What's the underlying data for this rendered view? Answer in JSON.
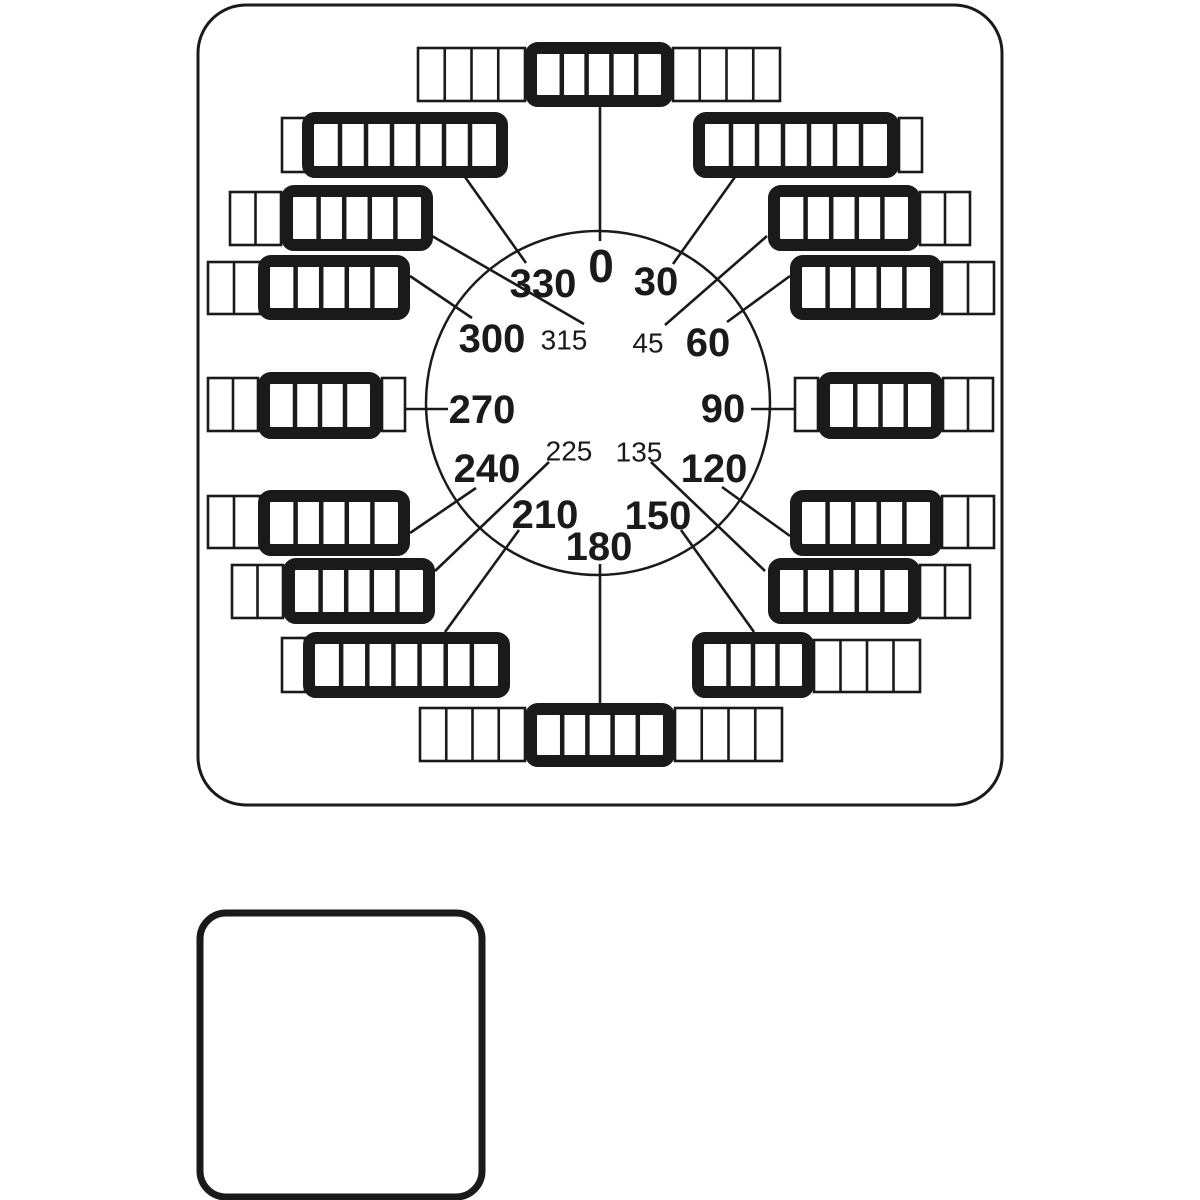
{
  "diagram": {
    "description": "Rotary dial diagram with degree circle and segmented switch blocks at each angle, plus a blank rounded panel below",
    "ink_color": "#1a1a1a",
    "background_color": "#ffffff",
    "panel": {
      "x": 198,
      "y": 5,
      "w": 804,
      "h": 800,
      "rx": 48,
      "stroke_w": 3
    },
    "circle": {
      "cx": 598,
      "cy": 403,
      "r": 172,
      "stroke_w": 2.5
    },
    "blank_panel": {
      "x": 200,
      "y": 913,
      "w": 282,
      "h": 284,
      "rx": 26,
      "stroke_w": 7
    },
    "labels_major": [
      {
        "text": "0",
        "x": 601,
        "y": 266,
        "size": 46
      },
      {
        "text": "30",
        "x": 656,
        "y": 282,
        "size": 40
      },
      {
        "text": "60",
        "x": 708,
        "y": 343,
        "size": 40
      },
      {
        "text": "90",
        "x": 723,
        "y": 409,
        "size": 40
      },
      {
        "text": "120",
        "x": 714,
        "y": 469,
        "size": 40
      },
      {
        "text": "150",
        "x": 658,
        "y": 516,
        "size": 40
      },
      {
        "text": "180",
        "x": 599,
        "y": 547,
        "size": 40
      },
      {
        "text": "210",
        "x": 545,
        "y": 515,
        "size": 40
      },
      {
        "text": "240",
        "x": 487,
        "y": 469,
        "size": 40
      },
      {
        "text": "270",
        "x": 482,
        "y": 410,
        "size": 40
      },
      {
        "text": "300",
        "x": 492,
        "y": 339,
        "size": 40
      },
      {
        "text": "330",
        "x": 543,
        "y": 284,
        "size": 40
      }
    ],
    "labels_minor": [
      {
        "text": "45",
        "x": 648,
        "y": 343,
        "size": 28
      },
      {
        "text": "135",
        "x": 639,
        "y": 452,
        "size": 28
      },
      {
        "text": "225",
        "x": 569,
        "y": 451,
        "size": 28
      },
      {
        "text": "315",
        "x": 564,
        "y": 340,
        "size": 28
      }
    ],
    "bars": [
      {
        "angle": "0",
        "line": [
          600,
          107,
          600,
          241
        ],
        "segments": [
          {
            "style": "thin",
            "x": 418,
            "y": 48,
            "w": 107,
            "h": 53,
            "cells": 4
          },
          {
            "style": "thick",
            "x": 525,
            "y": 42,
            "w": 148,
            "h": 65,
            "cells": 5
          },
          {
            "style": "thin",
            "x": 673,
            "y": 48,
            "w": 107,
            "h": 53,
            "cells": 4
          }
        ]
      },
      {
        "angle": "30",
        "line": [
          735,
          177,
          673,
          264
        ],
        "segments": [
          {
            "style": "thick",
            "x": 693,
            "y": 112,
            "w": 206,
            "h": 66,
            "cells": 7
          },
          {
            "style": "thin",
            "x": 899,
            "y": 118,
            "w": 23,
            "h": 54,
            "cells": 1
          }
        ]
      },
      {
        "angle": "45",
        "line": [
          767,
          236,
          665,
          325
        ],
        "segments": [
          {
            "style": "thick",
            "x": 768,
            "y": 185,
            "w": 152,
            "h": 66,
            "cells": 5
          },
          {
            "style": "thin",
            "x": 920,
            "y": 192,
            "w": 50,
            "h": 53,
            "cells": 2
          }
        ]
      },
      {
        "angle": "60",
        "line": [
          790,
          276,
          727,
          322
        ],
        "segments": [
          {
            "style": "thick",
            "x": 790,
            "y": 255,
            "w": 152,
            "h": 65,
            "cells": 5
          },
          {
            "style": "thin",
            "x": 942,
            "y": 262,
            "w": 52,
            "h": 52,
            "cells": 2
          }
        ]
      },
      {
        "angle": "90",
        "line": [
          751,
          409,
          795,
          409
        ],
        "segments": [
          {
            "style": "thin",
            "x": 795,
            "y": 378,
            "w": 23,
            "h": 53,
            "cells": 1
          },
          {
            "style": "thick",
            "x": 818,
            "y": 372,
            "w": 125,
            "h": 67,
            "cells": 4
          },
          {
            "style": "thin",
            "x": 943,
            "y": 378,
            "w": 50,
            "h": 53,
            "cells": 2
          }
        ]
      },
      {
        "angle": "120",
        "line": [
          722,
          487,
          790,
          536
        ],
        "segments": [
          {
            "style": "thick",
            "x": 790,
            "y": 490,
            "w": 152,
            "h": 66,
            "cells": 5
          },
          {
            "style": "thin",
            "x": 942,
            "y": 496,
            "w": 52,
            "h": 52,
            "cells": 2
          }
        ]
      },
      {
        "angle": "135",
        "line": [
          651,
          462,
          765,
          571
        ],
        "segments": [
          {
            "style": "thick",
            "x": 768,
            "y": 558,
            "w": 152,
            "h": 66,
            "cells": 5
          },
          {
            "style": "thin",
            "x": 920,
            "y": 565,
            "w": 50,
            "h": 53,
            "cells": 2
          }
        ]
      },
      {
        "angle": "150",
        "line": [
          754,
          632,
          681,
          530
        ],
        "segments": [
          {
            "style": "thick",
            "x": 692,
            "y": 632,
            "w": 122,
            "h": 66,
            "cells": 4
          },
          {
            "style": "thin",
            "x": 814,
            "y": 640,
            "w": 106,
            "h": 52,
            "cells": 4
          }
        ]
      },
      {
        "angle": "180",
        "line": [
          600,
          564,
          600,
          704
        ],
        "segments": [
          {
            "style": "thin",
            "x": 420,
            "y": 708,
            "w": 105,
            "h": 53,
            "cells": 4
          },
          {
            "style": "thick",
            "x": 525,
            "y": 703,
            "w": 150,
            "h": 64,
            "cells": 5
          },
          {
            "style": "thin",
            "x": 675,
            "y": 708,
            "w": 107,
            "h": 53,
            "cells": 4
          }
        ]
      },
      {
        "angle": "210",
        "line": [
          445,
          632,
          519,
          530
        ],
        "segments": [
          {
            "style": "thin",
            "x": 282,
            "y": 638,
            "w": 23,
            "h": 54,
            "cells": 1
          },
          {
            "style": "thick",
            "x": 303,
            "y": 632,
            "w": 207,
            "h": 66,
            "cells": 7
          }
        ]
      },
      {
        "angle": "225",
        "line": [
          435,
          571,
          549,
          462
        ],
        "segments": [
          {
            "style": "thin",
            "x": 232,
            "y": 565,
            "w": 51,
            "h": 53,
            "cells": 2
          },
          {
            "style": "thick",
            "x": 283,
            "y": 558,
            "w": 152,
            "h": 66,
            "cells": 5
          }
        ]
      },
      {
        "angle": "240",
        "line": [
          410,
          533,
          476,
          488
        ],
        "segments": [
          {
            "style": "thin",
            "x": 208,
            "y": 496,
            "w": 52,
            "h": 52,
            "cells": 2
          },
          {
            "style": "thick",
            "x": 258,
            "y": 490,
            "w": 152,
            "h": 66,
            "cells": 5
          }
        ]
      },
      {
        "angle": "270",
        "line": [
          405,
          409,
          448,
          409
        ],
        "segments": [
          {
            "style": "thin",
            "x": 208,
            "y": 378,
            "w": 50,
            "h": 53,
            "cells": 2
          },
          {
            "style": "thick",
            "x": 258,
            "y": 372,
            "w": 124,
            "h": 67,
            "cells": 4
          },
          {
            "style": "thin",
            "x": 382,
            "y": 378,
            "w": 23,
            "h": 53,
            "cells": 1
          }
        ]
      },
      {
        "angle": "300",
        "line": [
          410,
          276,
          472,
          318
        ],
        "segments": [
          {
            "style": "thin",
            "x": 208,
            "y": 262,
            "w": 52,
            "h": 52,
            "cells": 2
          },
          {
            "style": "thick",
            "x": 258,
            "y": 255,
            "w": 152,
            "h": 65,
            "cells": 5
          }
        ]
      },
      {
        "angle": "315",
        "line": [
          432,
          236,
          584,
          324
        ],
        "segments": [
          {
            "style": "thin",
            "x": 230,
            "y": 192,
            "w": 51,
            "h": 53,
            "cells": 2
          },
          {
            "style": "thick",
            "x": 281,
            "y": 185,
            "w": 152,
            "h": 66,
            "cells": 5
          }
        ]
      },
      {
        "angle": "330",
        "line": [
          465,
          177,
          526,
          263
        ],
        "segments": [
          {
            "style": "thin",
            "x": 282,
            "y": 118,
            "w": 23,
            "h": 54,
            "cells": 1
          },
          {
            "style": "thick",
            "x": 302,
            "y": 112,
            "w": 206,
            "h": 66,
            "cells": 7
          }
        ]
      }
    ]
  }
}
